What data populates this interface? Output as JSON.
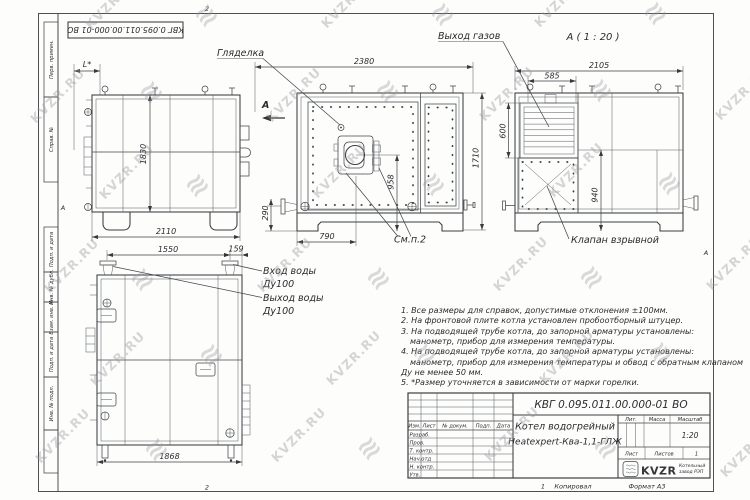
{
  "watermark": {
    "text": "KVZR.RU",
    "color": "#9a9aa0"
  },
  "frame": {
    "doc_number_rotated": "КВГ 0.095.011.00.000-01 ВО",
    "side_fields": [
      "Перв. примен.",
      "Справ. №",
      "Подп. и дата",
      "Инв. № дубл.",
      "Взам. инв. №",
      "Подп. и дата",
      "Инв. № подл."
    ],
    "zones": {
      "top": "2",
      "left": "А",
      "right": "А",
      "bottom": "2"
    }
  },
  "views": {
    "side": {
      "dim_top": "L*",
      "dim_height": "1830",
      "dim_width": "2110"
    },
    "front": {
      "label_peephole": "Гляделка",
      "section_letter": "А",
      "dim_width": "2380",
      "dim_height": "1710",
      "dim_burner_axis": "958",
      "dim_790": "790",
      "dim_290": "290",
      "see_note": "См.п.2"
    },
    "rear": {
      "title": "А ( 1 : 20 )",
      "label_gas_outlet": "Выход газов",
      "label_explosion_valve": "Клапан взрывной",
      "dim_width": "2105",
      "dim_585": "585",
      "dim_600": "600",
      "dim_940": "940"
    },
    "back": {
      "dim_1550": "1550",
      "dim_159": "159",
      "dim_1868": "1868",
      "label_water_in_1": "Вход воды",
      "label_water_in_2": "Ду100",
      "label_water_out_1": "Выход воды",
      "label_water_out_2": "Ду100"
    }
  },
  "notes": {
    "lines": [
      "1. Все размеры для справок, допустимые отклонения ±100мм.",
      "2. На фронтовой плите котла установлен пробоотборный штуцер.",
      "3. На подводящей трубе котла, до запорной арматуры установлены:",
      "манометр, прибор для измерения температуры.",
      "4. На подводящей трубе котла, до запорной арматуры установлены:",
      "манометр, прибор для измерения температуры и обвод с обратным клапаном",
      "Ду не менее 50 мм.",
      "5. *Размер уточняется в зависимости от марки горелки."
    ]
  },
  "title_block": {
    "doc_number": "КВГ 0.095.011.00.000-01 ВО",
    "name_line1": "Котел водогрейный",
    "name_line2": "Heatexpert-Ква-1,1-ГЛЖ",
    "col_izm": "Изм.",
    "col_list": "Лист",
    "col_doc": "№ докум.",
    "col_podp": "Подп.",
    "col_data": "Дата",
    "row_labels": [
      "Разраб.",
      "Пров.",
      "Т. контр.",
      "Нач.отд",
      "Н. контр.",
      "Утв."
    ],
    "lit_label": "Лит.",
    "mass_label": "Масса",
    "scale_label": "Масштаб",
    "scale_value": "1:20",
    "sheet_label": "Лист",
    "sheets_label": "Листов",
    "sheets_value": "1",
    "logo_text": "KVZR",
    "logo_sub1": "Котельный",
    "logo_sub2": "завод РЭП"
  },
  "footer": {
    "zone": "1",
    "copied": "Копировал",
    "format": "Формат А3"
  }
}
